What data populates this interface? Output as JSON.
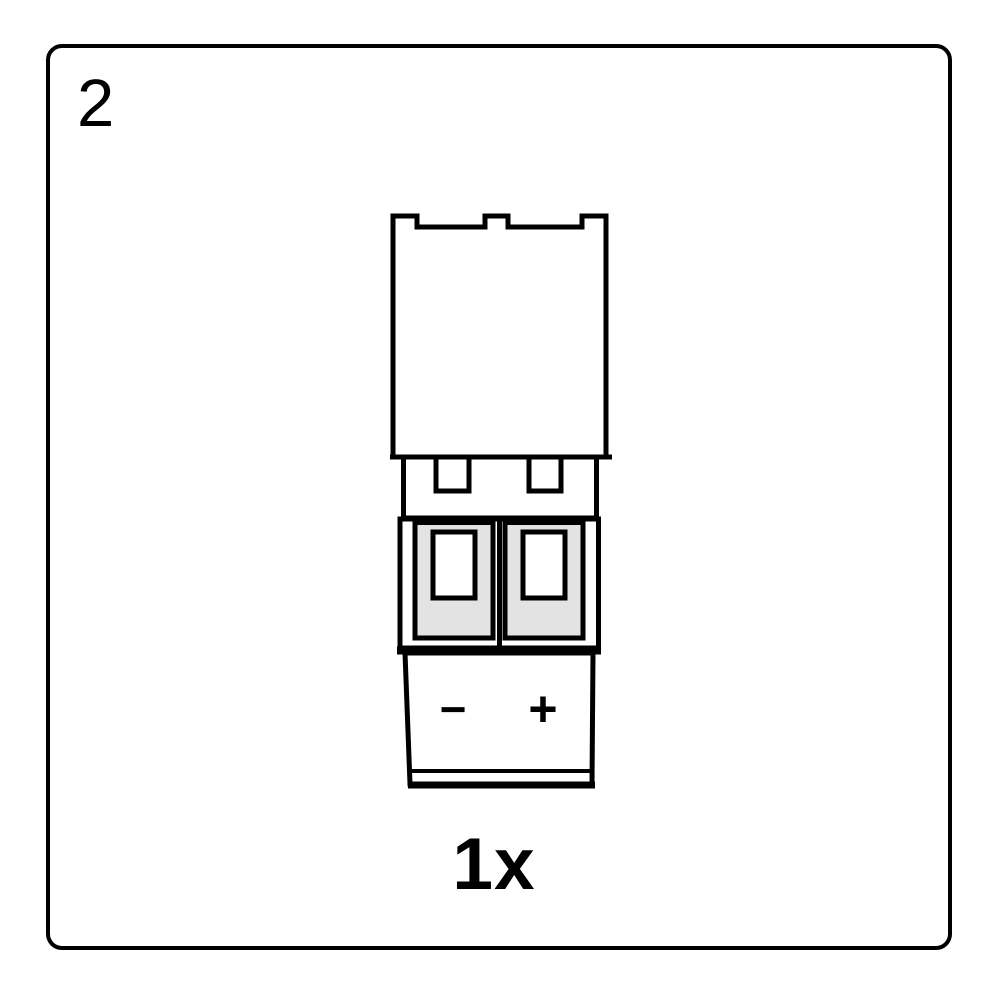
{
  "page": {
    "step_number": "2",
    "quantity_label": "1x",
    "background_color": "#ffffff",
    "border_color": "#000000"
  },
  "diagram": {
    "part_icon": "two-pin-terminal-block-connector-icon",
    "polarity_negative": "−",
    "polarity_positive": "+",
    "colors": {
      "line": "#000000",
      "fill": "#ffffff",
      "terminal_fill": "#e3e3e3"
    }
  }
}
